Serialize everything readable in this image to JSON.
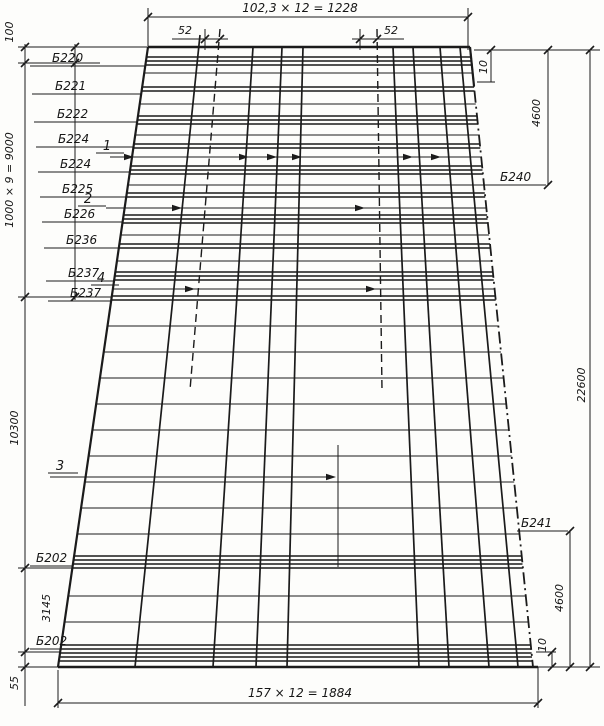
{
  "drawing": {
    "ink_color": "#1b1b1b",
    "paper_color": "#fdfdfb",
    "dims": {
      "top": "102,3 × 12 = 1228",
      "bottom": "157 × 12 = 1884",
      "left_100": "100",
      "left_9000": "1000 × 9 = 9000",
      "left_10300": "10300",
      "left_3145": "3145",
      "left_55": "55",
      "right_10_top": "10",
      "right_4600_top": "4600",
      "right_22600": "22600",
      "right_4600_bottom": "4600",
      "right_10_bottom": "10",
      "spacing_52_left": "52",
      "spacing_52_right": "52"
    },
    "beam_labels_left": [
      "Б220",
      "Б221",
      "Б222",
      "Б224",
      "Б224",
      "Б225",
      "Б226",
      "Б236",
      "Б237",
      "Б237",
      "Б202",
      "Б202"
    ],
    "beam_labels_right": {
      "b240": "Б240",
      "b241": "Б241"
    },
    "marks": {
      "m1": "1",
      "m2": "2",
      "m3": "3",
      "m4": "4"
    }
  }
}
